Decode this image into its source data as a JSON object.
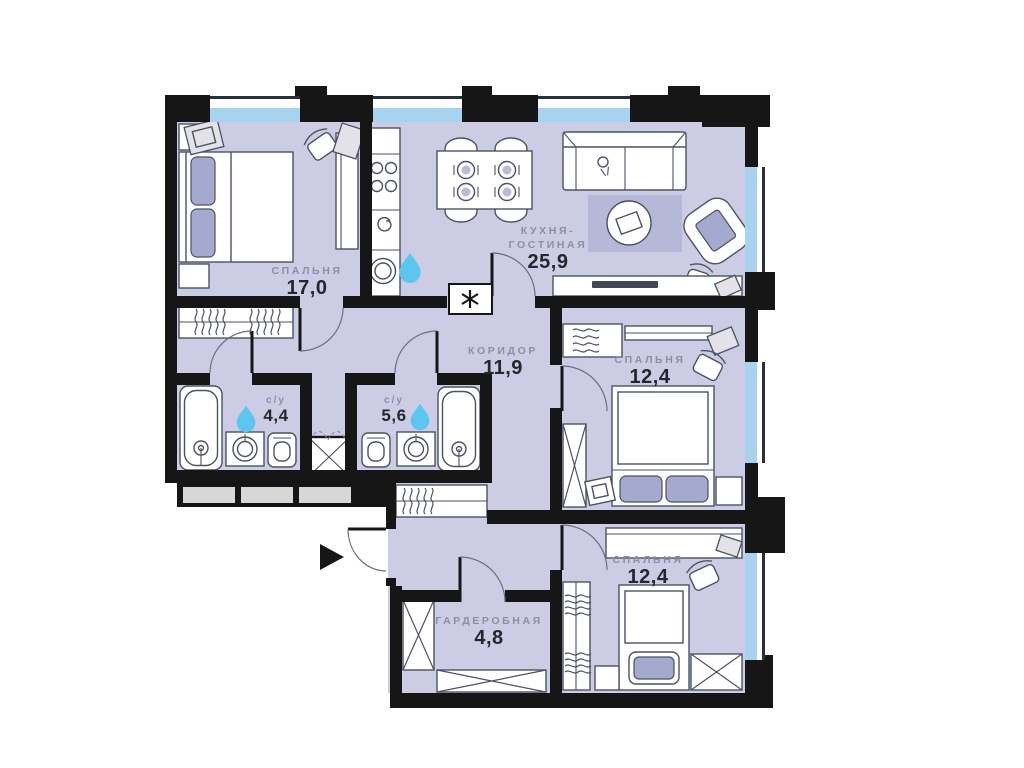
{
  "title": "Apartment floor plan",
  "rooms": [
    {
      "id": "bedroom-1",
      "name": "СПАЛЬНЯ",
      "area": "17,0"
    },
    {
      "id": "kitchen-living-room",
      "name_line1": "КУХНЯ-",
      "name_line2": "ГОСТИНАЯ",
      "area": "25,9"
    },
    {
      "id": "corridor",
      "name": "КОРИДОР",
      "area": "11,9"
    },
    {
      "id": "bedroom-2",
      "name": "СПАЛЬНЯ",
      "area": "12,4"
    },
    {
      "id": "bathroom-1",
      "name": "с/у",
      "area": "4,4"
    },
    {
      "id": "bathroom-2",
      "name": "с/у",
      "area": "5,6"
    },
    {
      "id": "wardrobe-room",
      "name": "ГАРДЕРОБНАЯ",
      "area": "4,8"
    },
    {
      "id": "bedroom-3",
      "name": "СПАЛЬНЯ",
      "area": "12,4"
    }
  ],
  "markers": {
    "entrance_arrow": "entrance-direction-arrow",
    "water_drop": "water-supply-point",
    "appliance_asterisk": "washing-machine-place"
  },
  "colors": {
    "wall": "#161616",
    "floor": "#cccde4",
    "rug": "#b6b8d7",
    "cushion": "#a6a9ce",
    "window_blue": "#a8d3ee",
    "water_drop": "#5cc6f1",
    "label_name": "#8b8fa6",
    "label_area": "#26262e",
    "panel_gray": "#d7d7d7"
  }
}
